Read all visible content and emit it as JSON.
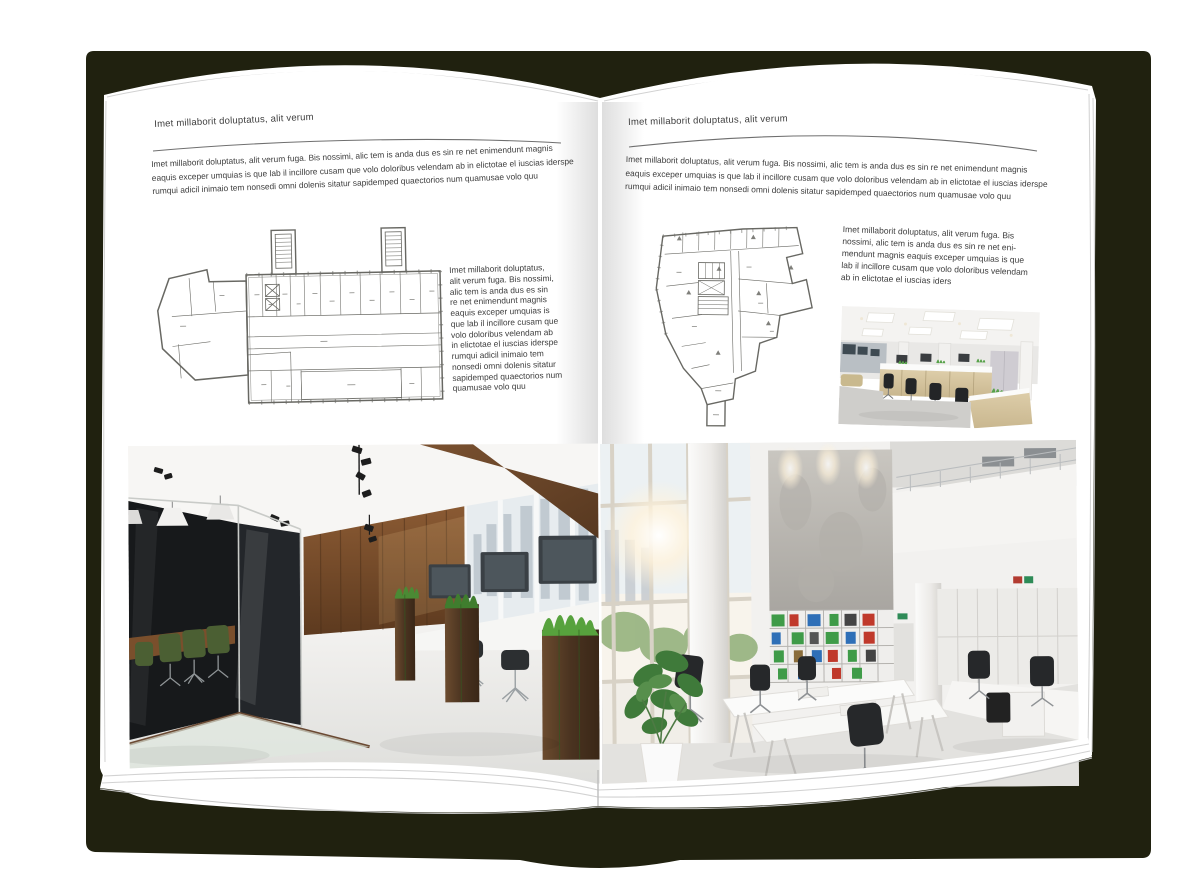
{
  "colors": {
    "backdrop": "#20210f",
    "page": "#ffffff",
    "text": "#3d3d3d",
    "rule": "#6f6f6f"
  },
  "pages": {
    "left": {
      "header": "Imet millaborit doluptatus, alit verum",
      "body": "Imet millaborit doluptatus, alit verum fuga. Bis nossimi, alic tem is anda dus es sin re net enimendunt magnis\neaquis exceper umquias is que lab il incillore cusam que volo doloribus velendam ab in elictotae el iuscias iderspe\nrumqui adicil inimaio tem nonsedi omni dolenis sitatur sapidemped quaectorios num quamusae volo quu",
      "caption": "Imet millaborit doluptatus,\nalit verum fuga. Bis nossimi,\nalic tem is anda dus es sin\nre net enimendunt magnis\neaquis exceper umquias is\nque lab il incillore cusam que\nvolo doloribus velendam ab\nin elictotae el iuscias iderspe\nrumqui adicil inimaio tem\nnonsedi omni dolenis sitatur\nsapidemped quaectorios num\nquamusae volo quu"
    },
    "right": {
      "header": "Imet millaborit doluptatus, alit verum",
      "body": "Imet millaborit doluptatus, alit verum fuga. Bis nossimi, alic tem is anda dus es sin re net enimendunt magnis\neaquis exceper umquias is que lab il incillore cusam que volo doloribus velendam ab in elictotae el iuscias iderspe\nrumqui adicil inimaio tem nonsedi omni dolenis sitatur sapidemped quaectorios num quamusae volo quu",
      "caption": "Imet millaborit doluptatus, alit verum fuga. Bis\nnossimi, alic tem is anda dus es sin re net eni-\nmendunt magnis eaquis exceper umquias is que\nlab il incillore cusam que volo doloribus velendam\nab in elictotae el iuscias iders"
    }
  }
}
